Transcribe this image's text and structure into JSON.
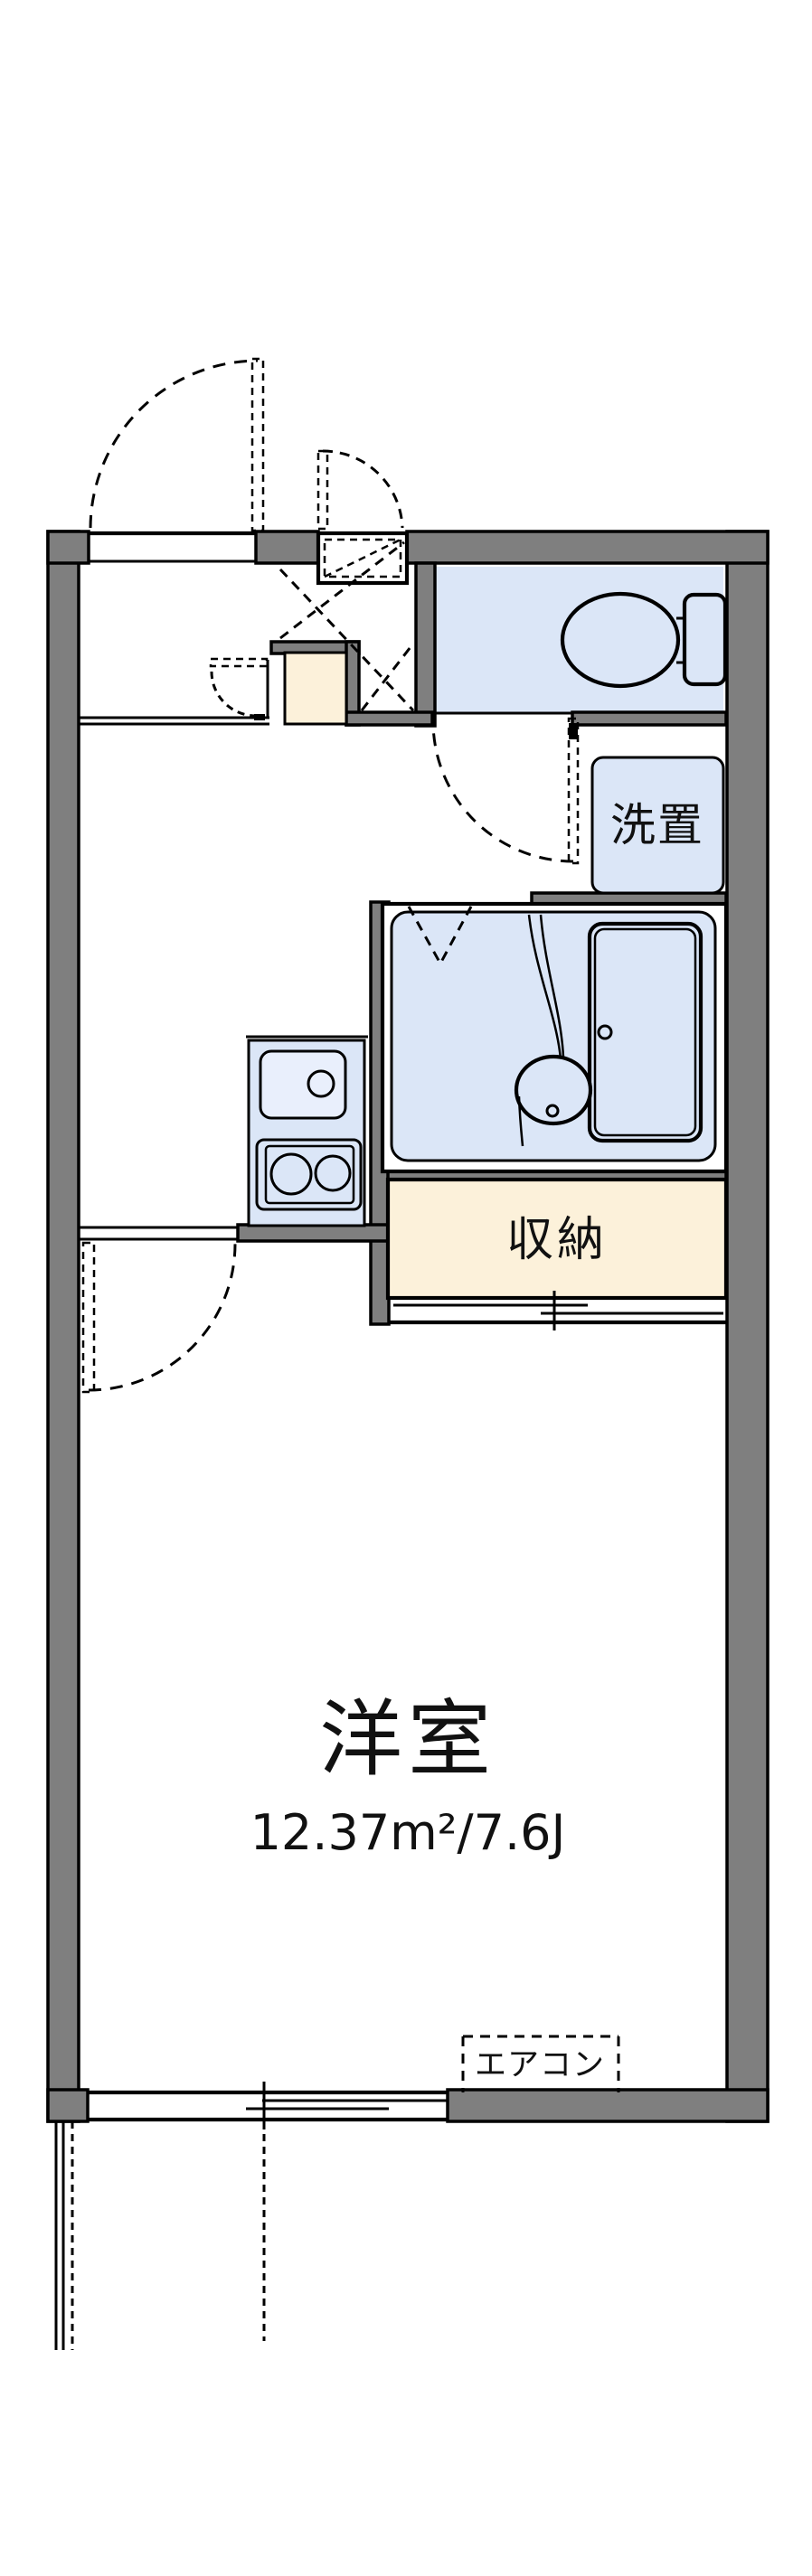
{
  "figure": "floor-plan",
  "colors": {
    "background": "#ffffff",
    "wall": "#7f7f7f",
    "line": "#000000",
    "fixture": "#dbe6f7",
    "fixture_light": "#e9effc",
    "storage": "#fcf1da"
  },
  "labels": {
    "room": "洋室",
    "room_area": "12.37m²/7.6J",
    "storage": "収納",
    "washer": "洗置",
    "aircon": "エアコン"
  }
}
